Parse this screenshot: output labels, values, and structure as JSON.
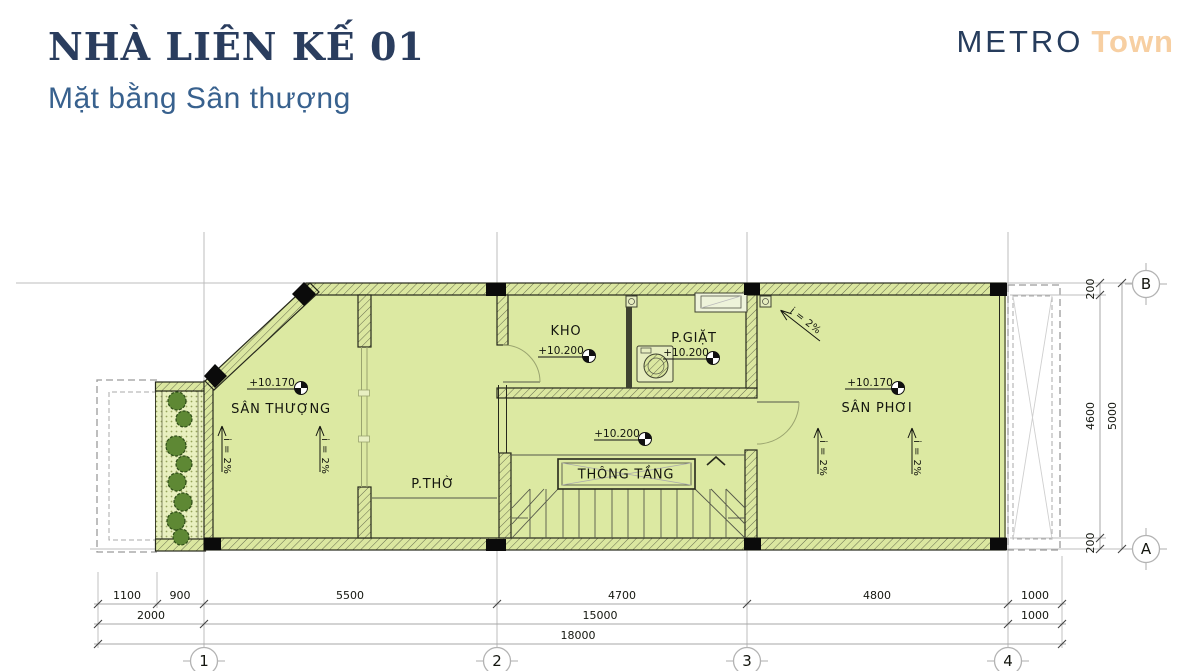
{
  "header": {
    "title": "NHÀ LIÊN KẾ 01",
    "subtitle": "Mặt bằng Sân thượng",
    "logo_metro": "METRO",
    "logo_town": "Town"
  },
  "rooms": {
    "san_thuong": {
      "label": "SÂN THƯỢNG",
      "elevation": "+10.170"
    },
    "p_tho": {
      "label": "P.THỜ"
    },
    "kho": {
      "label": "KHO",
      "elevation": "+10.200"
    },
    "p_giat": {
      "label": "P.GIẶT",
      "elevation": "+10.200"
    },
    "hall": {
      "elevation": "+10.200"
    },
    "thong_tang": {
      "label": "THÔNG TẦNG"
    },
    "san_phoi": {
      "label": "SÂN PHƠI",
      "elevation": "+10.170"
    }
  },
  "slope_label": "i = 2%",
  "grid": {
    "col1": "1",
    "col2": "2",
    "col3": "3",
    "col4": "4",
    "rowA": "A",
    "rowB": "B"
  },
  "dims": {
    "b1": "1100",
    "b2": "900",
    "b3": "5500",
    "b4": "4700",
    "b5": "4800",
    "b6": "1000",
    "m1": "2000",
    "m2": "15000",
    "m3": "1000",
    "t1": "18000",
    "r1": "200",
    "r2": "4600",
    "r3": "200",
    "r4": "5000"
  },
  "colors": {
    "floor": "#dce9a2",
    "navy": "#2a3d5e",
    "blue": "#38618e",
    "peach": "#f7cfa2"
  }
}
